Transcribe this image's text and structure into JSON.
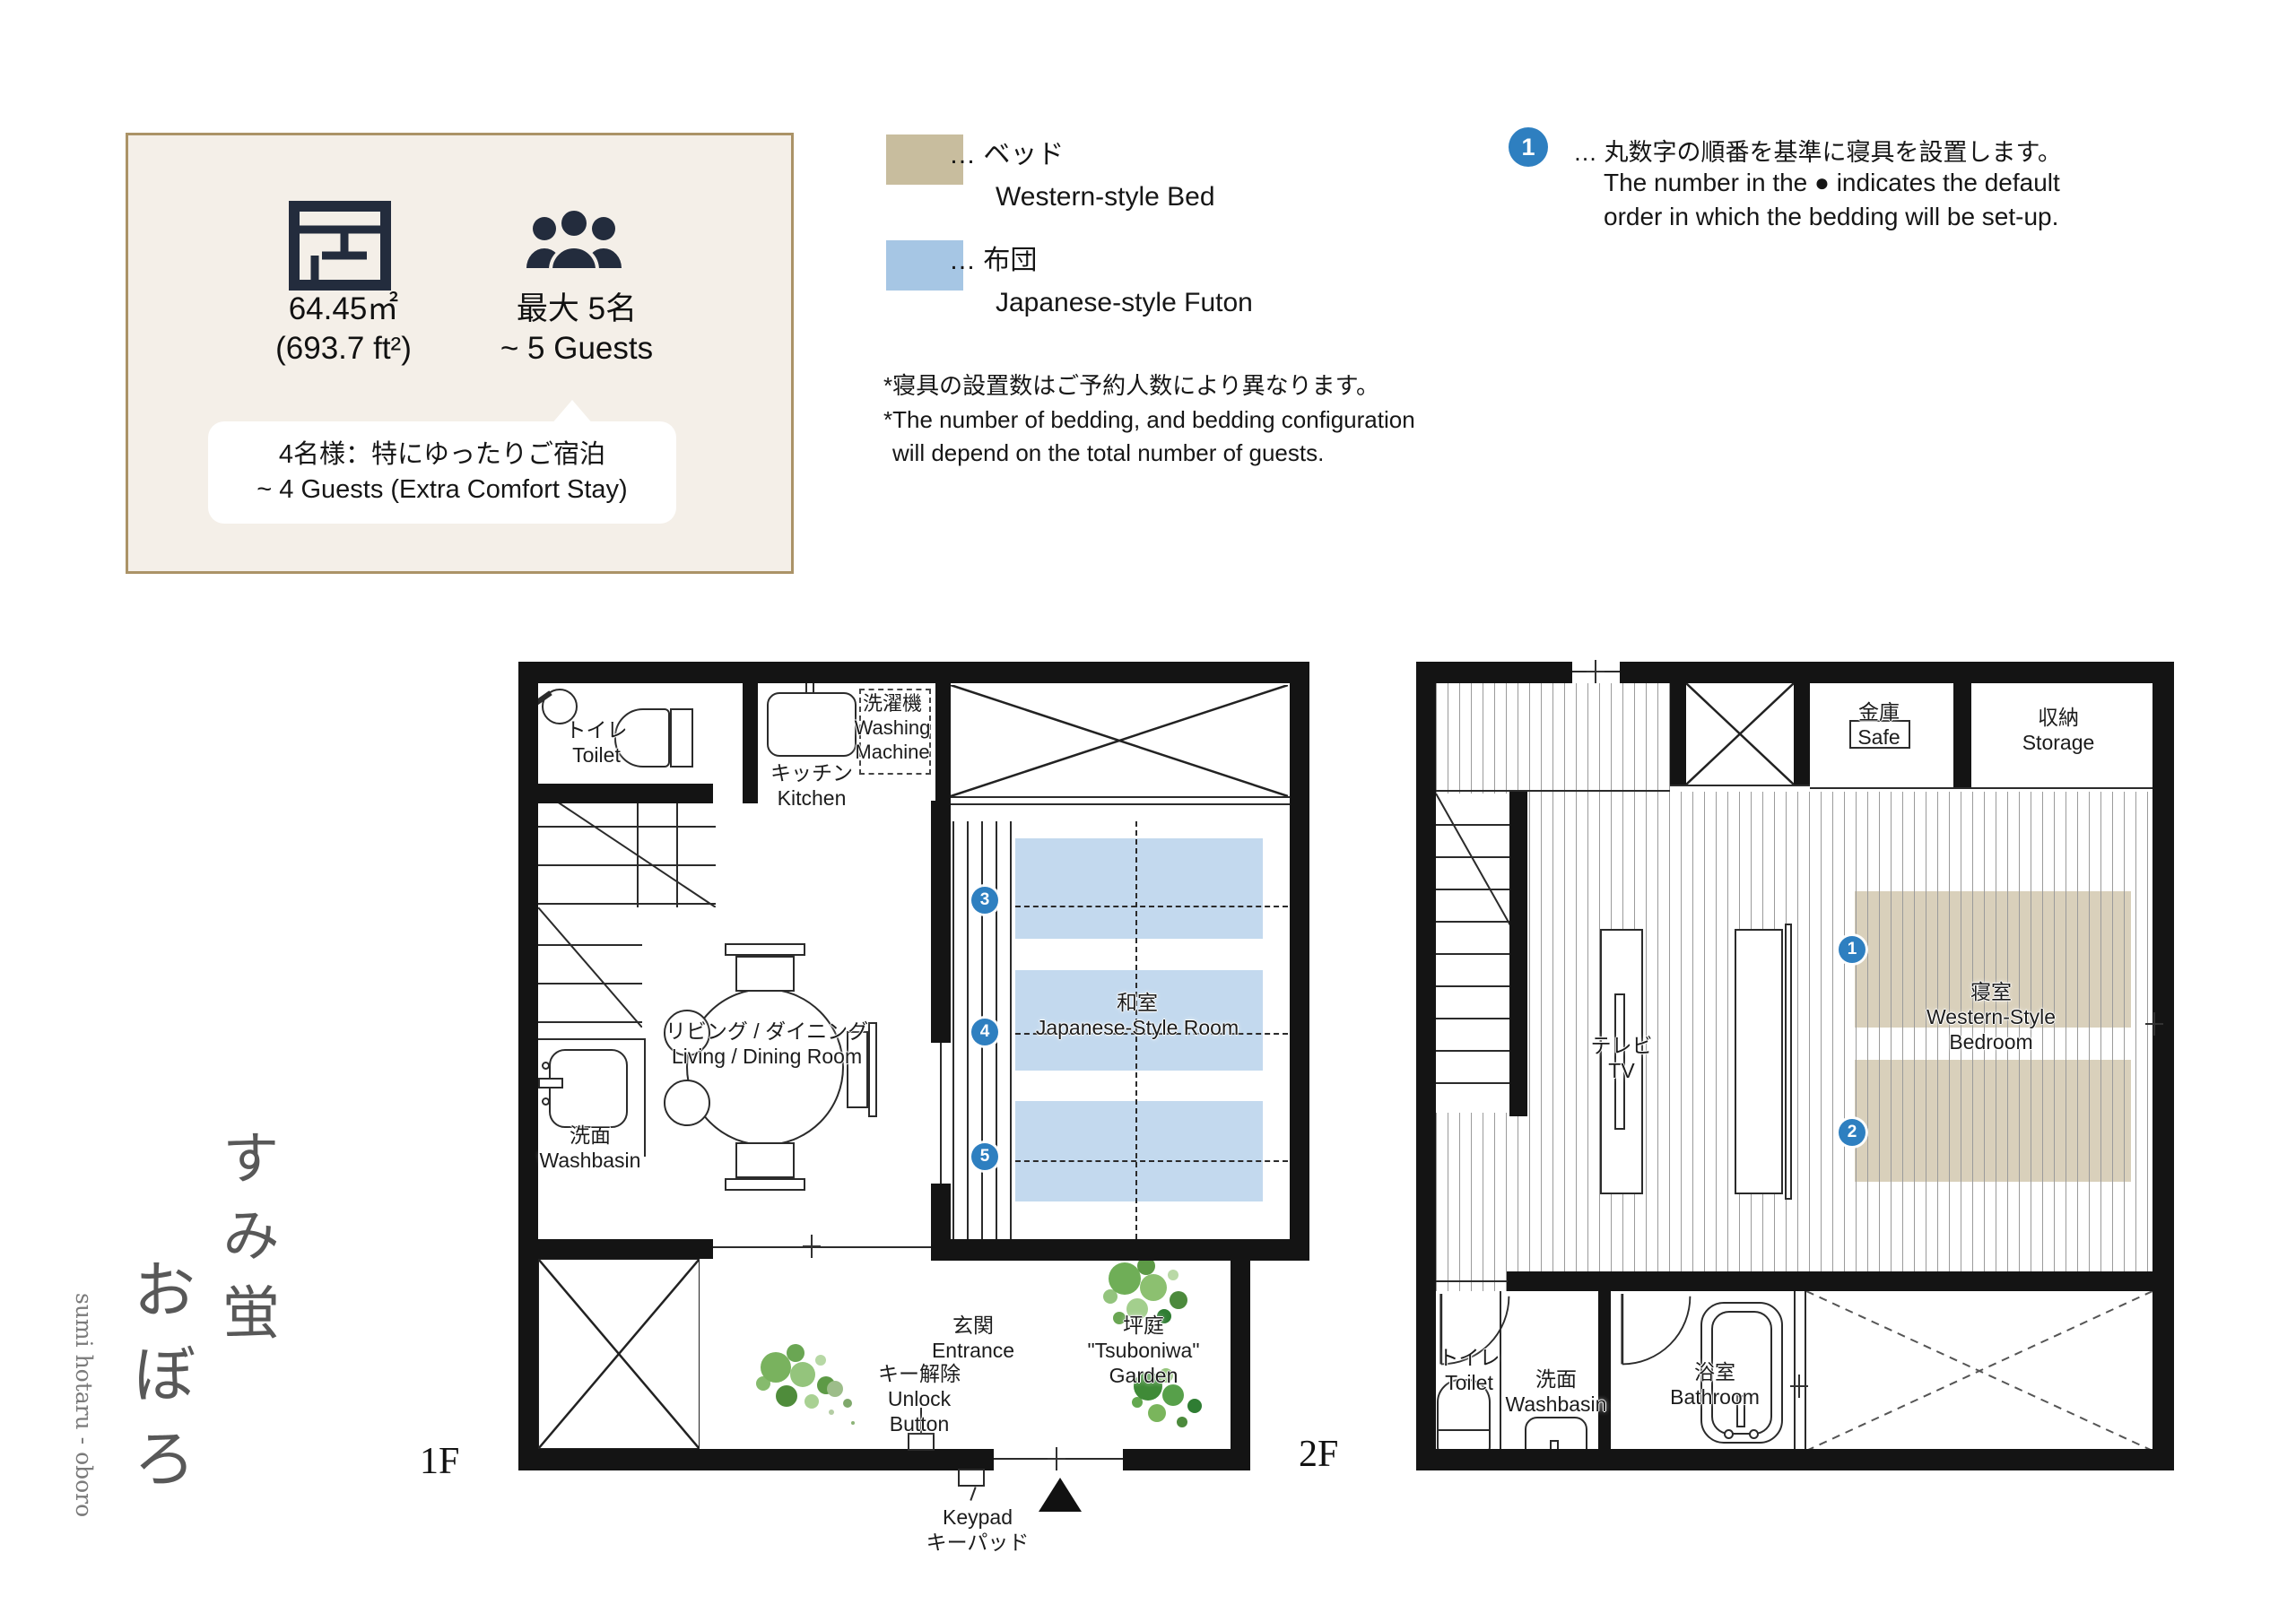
{
  "brand": {
    "jp_line1": "すみ蛍",
    "jp_line2": "おぼろ",
    "romaji": "sumi hotaru - oboro"
  },
  "info": {
    "area": "64.45㎡",
    "area_ft": "(693.7 ft²)",
    "capacity_jp": "最大 5名",
    "capacity_en": "~ 5 Guests",
    "comfort_jp": "4名様：特にゆったりご宿泊",
    "comfort_en": "~ 4 Guests (Extra Comfort Stay)"
  },
  "legend": {
    "bed": {
      "dots": "…",
      "jp": "ベッド",
      "en": "Western-style Bed",
      "color": "#c8bd9e"
    },
    "futon": {
      "dots": "…",
      "jp": "布団",
      "en": "Japanese-style Futon",
      "color": "#a6c6e4"
    },
    "note_jp": "*寝具の設置数はご予約人数により異なります。",
    "note_en1": "*The number of bedding, and bedding configuration",
    "note_en2": "will depend on the total number of guests."
  },
  "order_note": {
    "number": "1",
    "dots": "…",
    "jp": "丸数字の順番を基準に寝具を設置します。",
    "en1": "The number in the ● indicates the default",
    "en2": "order in which the bedding will be set-up.",
    "circle_color": "#2e7fc0"
  },
  "floor1": {
    "label": "1F",
    "toilet_jp": "トイレ",
    "toilet_en": "Toilet",
    "washing_jp": "洗濯機",
    "washing_en1": "Washing",
    "washing_en2": "Machine",
    "kitchen_jp": "キッチン",
    "kitchen_en": "Kitchen",
    "living_jp": "リビング / ダイニング",
    "living_en": "Living / Dining Room",
    "washbasin_jp": "洗面",
    "washbasin_en": "Washbasin",
    "japanese_jp": "和室",
    "japanese_en": "Japanese-Style Room",
    "futon_numbers": [
      "3",
      "4",
      "5"
    ],
    "entrance_jp": "玄関",
    "entrance_en": "Entrance",
    "unlock_jp": "キー解除",
    "unlock_en1": "Unlock",
    "unlock_en2": "Button",
    "keypad_en": "Keypad",
    "keypad_jp": "キーパッド",
    "garden_jp": "坪庭",
    "garden_en1": "\"Tsuboniwa\"",
    "garden_en2": "Garden"
  },
  "floor2": {
    "label": "2F",
    "safe_jp": "金庫",
    "safe_en": "Safe",
    "storage_jp": "収納",
    "storage_en": "Storage",
    "tv_jp": "テレビ",
    "tv_en": "TV",
    "bedroom_jp": "寝室",
    "bedroom_en1": "Western-Style",
    "bedroom_en2": "Bedroom",
    "bed_numbers": [
      "1",
      "2"
    ],
    "toilet_jp": "トイレ",
    "toilet_en": "Toilet",
    "washbasin_jp": "洗面",
    "washbasin_en": "Washbasin",
    "bathroom_jp": "浴室",
    "bathroom_en": "Bathroom"
  }
}
